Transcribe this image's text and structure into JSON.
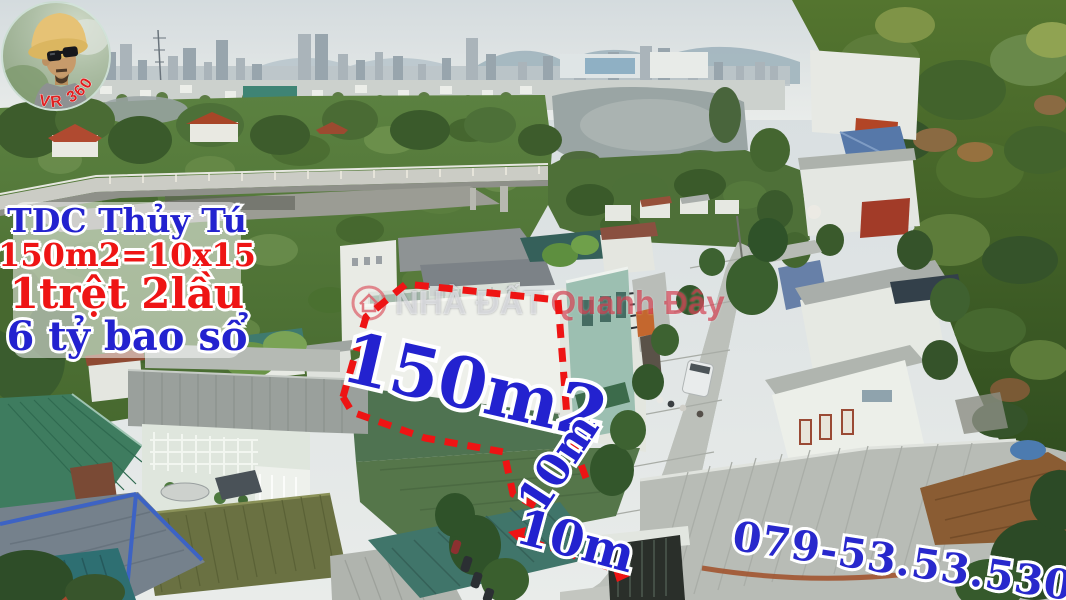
{
  "colors": {
    "accent_red": "#ee1414",
    "accent_blue": "#2322cf",
    "watermark_red": "#cd263a",
    "outline_white": "#ffffff"
  },
  "badge": {
    "phone_arc": "079-53-53-530",
    "vr": "VR 360"
  },
  "info_box": {
    "location": "TDC Thủy Tú",
    "area_dims": "150m2=10x15",
    "floors": "1trệt 2lầu",
    "price": "6 tỷ bao sổ"
  },
  "plot": {
    "area": "150m2",
    "depth": "10m",
    "frontage": "10m"
  },
  "watermark": {
    "brand_left": "NHÀ ĐẤT",
    "brand_right": "Quanh Đây"
  },
  "contact": {
    "phone": "079-53.53.530"
  }
}
